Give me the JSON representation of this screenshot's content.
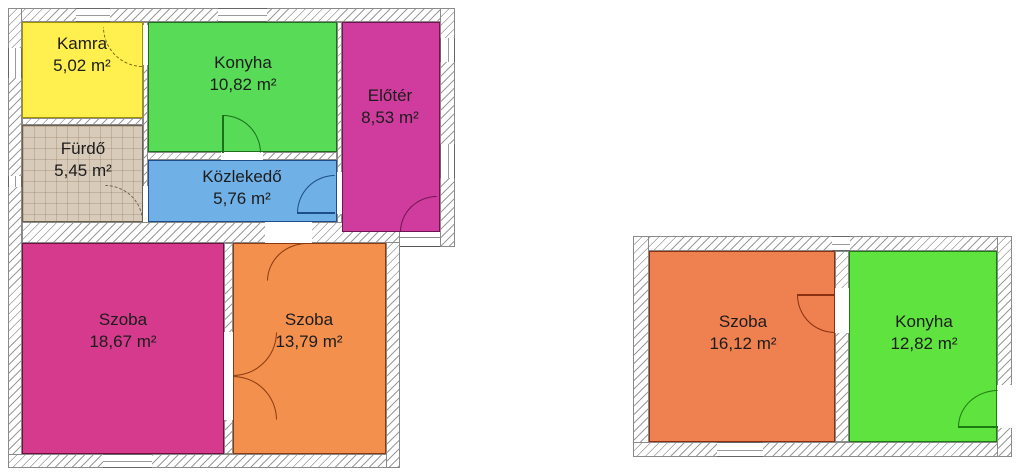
{
  "canvas": {
    "width": 1024,
    "height": 476,
    "background": "#ffffff"
  },
  "style": {
    "wall_hatch_color": "#9a9a9a",
    "wall_fill": "#ffffff",
    "outline_color": "#8a8a8a",
    "text_color": "#1c1c1c"
  },
  "buildings": [
    {
      "id": "left-building",
      "rooms": [
        {
          "id": "kamra",
          "label": "Kamra",
          "area": "5,02 m²",
          "fill": "#fff04f",
          "border": "#a39200"
        },
        {
          "id": "konyha",
          "label": "Konyha",
          "area": "10,82 m²",
          "fill": "#58dc58",
          "border": "#1d6e1d"
        },
        {
          "id": "eloter",
          "label": "Előtér",
          "area": "8,53 m²",
          "fill": "#d03c9e",
          "border": "#6e1450"
        },
        {
          "id": "furdo",
          "label": "Fürdő",
          "area": "5,45 m²",
          "fill": "#d9cbba",
          "border": "#6b5f4e"
        },
        {
          "id": "kozlekedo",
          "label": "Közlekedő",
          "area": "5,76 m²",
          "fill": "#6fb0e6",
          "border": "#1d4e87"
        },
        {
          "id": "szoba-1",
          "label": "Szoba",
          "area": "18,67 m²",
          "fill": "#d53a8c",
          "border": "#6e1040"
        },
        {
          "id": "szoba-2",
          "label": "Szoba",
          "area": "13,79 m²",
          "fill": "#f4904e",
          "border": "#8a3a10"
        }
      ]
    },
    {
      "id": "right-building",
      "rooms": [
        {
          "id": "szoba-3",
          "label": "Szoba",
          "area": "16,12 m²",
          "fill": "#ef8150",
          "border": "#8a3010"
        },
        {
          "id": "konyha-2",
          "label": "Konyha",
          "area": "12,82 m²",
          "fill": "#5fe43f",
          "border": "#1d7a10"
        }
      ]
    }
  ]
}
